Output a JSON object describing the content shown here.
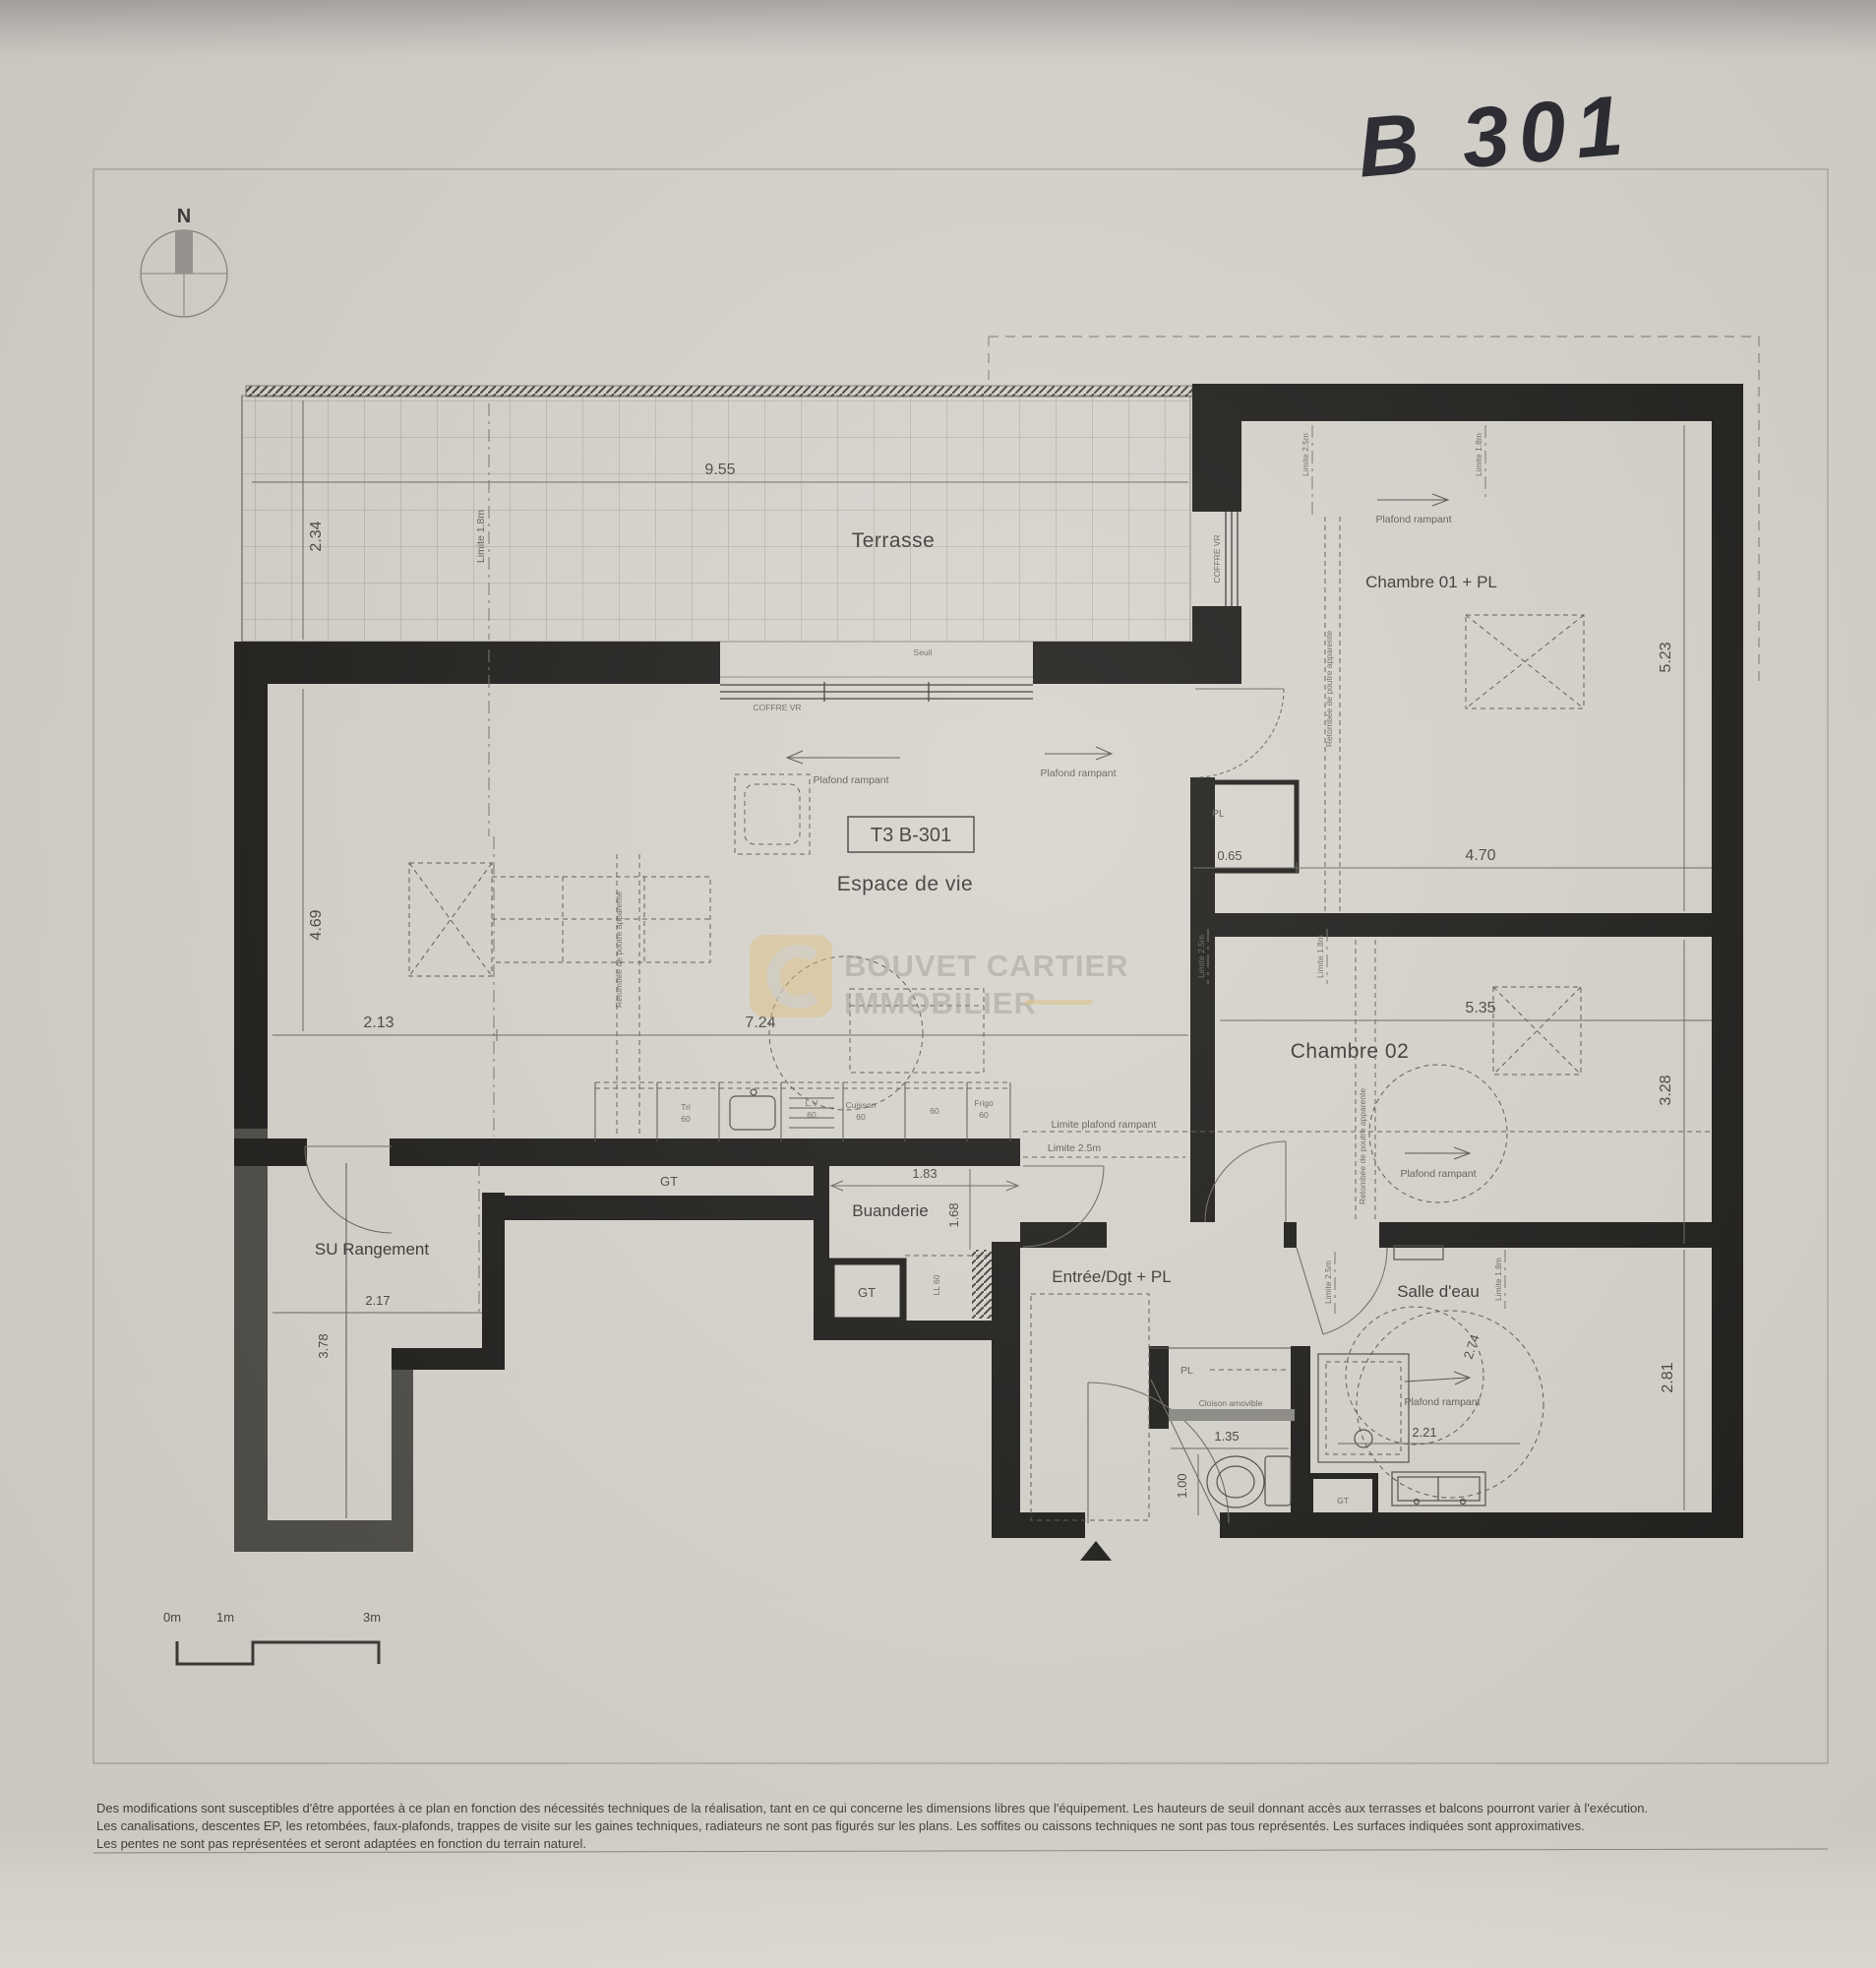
{
  "photo": {
    "handwritten_label": "B 301"
  },
  "compass": {
    "north": "N"
  },
  "plan": {
    "unit_label": "T3 B-301",
    "rooms": {
      "terrasse": "Terrasse",
      "chambre01": "Chambre 01 + PL",
      "chambre02": "Chambre 02",
      "espace": "Espace de vie",
      "buanderie": "Buanderie",
      "rangement": "SU Rangement",
      "entree": "Entrée/Dgt + PL",
      "salle_eau": "Salle d'eau"
    },
    "annotations": {
      "plafond_rampant": "Plafond rampant",
      "limite_plafond_rampant": "Limite plafond rampant",
      "limite_25": "Limite 2.5m",
      "limite_18": "Limite 1.8m",
      "retombee": "Retombée de poutre apparente",
      "coffre_vr": "COFFRE VR",
      "seuil": "Seuil",
      "cloison_amovible": "Cloison amovible",
      "gt": "GT",
      "pl": "PL",
      "ll60": "LL 60"
    },
    "kitchen": {
      "tri": "Tri",
      "lv": "L.V",
      "cuisson": "Cuisson",
      "n60": "60",
      "frigo": "Frigo"
    },
    "dimensions": {
      "terrasse_w": "9.55",
      "terrasse_d": "2.34",
      "espace_d": "4.69",
      "espace_w1": "2.13",
      "espace_w2": "7.24",
      "ch1_d": "5.23",
      "ch1_w": "4.70",
      "pl_w": "0.65",
      "ch2_w": "5.35",
      "ch2_d": "3.28",
      "sde_d": "2.81",
      "sde_diag": "2.74",
      "sde_w": "2.21",
      "buanderie_w": "1.83",
      "buanderie_d": "1.68",
      "rangement_w": "2.17",
      "rangement_d": "3.78",
      "wc_w": "1.35",
      "wc_d": "1.00"
    }
  },
  "scale_bar": {
    "m0": "0m",
    "m1": "1m",
    "m3": "3m"
  },
  "watermark": {
    "line1": "BOUVET CARTIER",
    "line2": "IMMOBILIER"
  },
  "footer": {
    "line1": "Des modifications sont susceptibles d'être apportées à ce plan en fonction des nécessités techniques de la réalisation, tant en ce qui concerne les dimensions libres que l'équipement. Les hauteurs de seuil donnant accès aux terrasses et balcons pourront varier à l'exécution.",
    "line2": "Les canalisations, descentes EP, les retombées, faux-plafonds, trappes de visite sur les gaines techniques, radiateurs ne sont pas figurés sur les plans. Les soffites ou caissons techniques ne sont pas tous représentés. Les surfaces indiquées sont approximatives.",
    "line3": "Les pentes ne sont pas représentées et seront adaptées en fonction du terrain naturel."
  }
}
